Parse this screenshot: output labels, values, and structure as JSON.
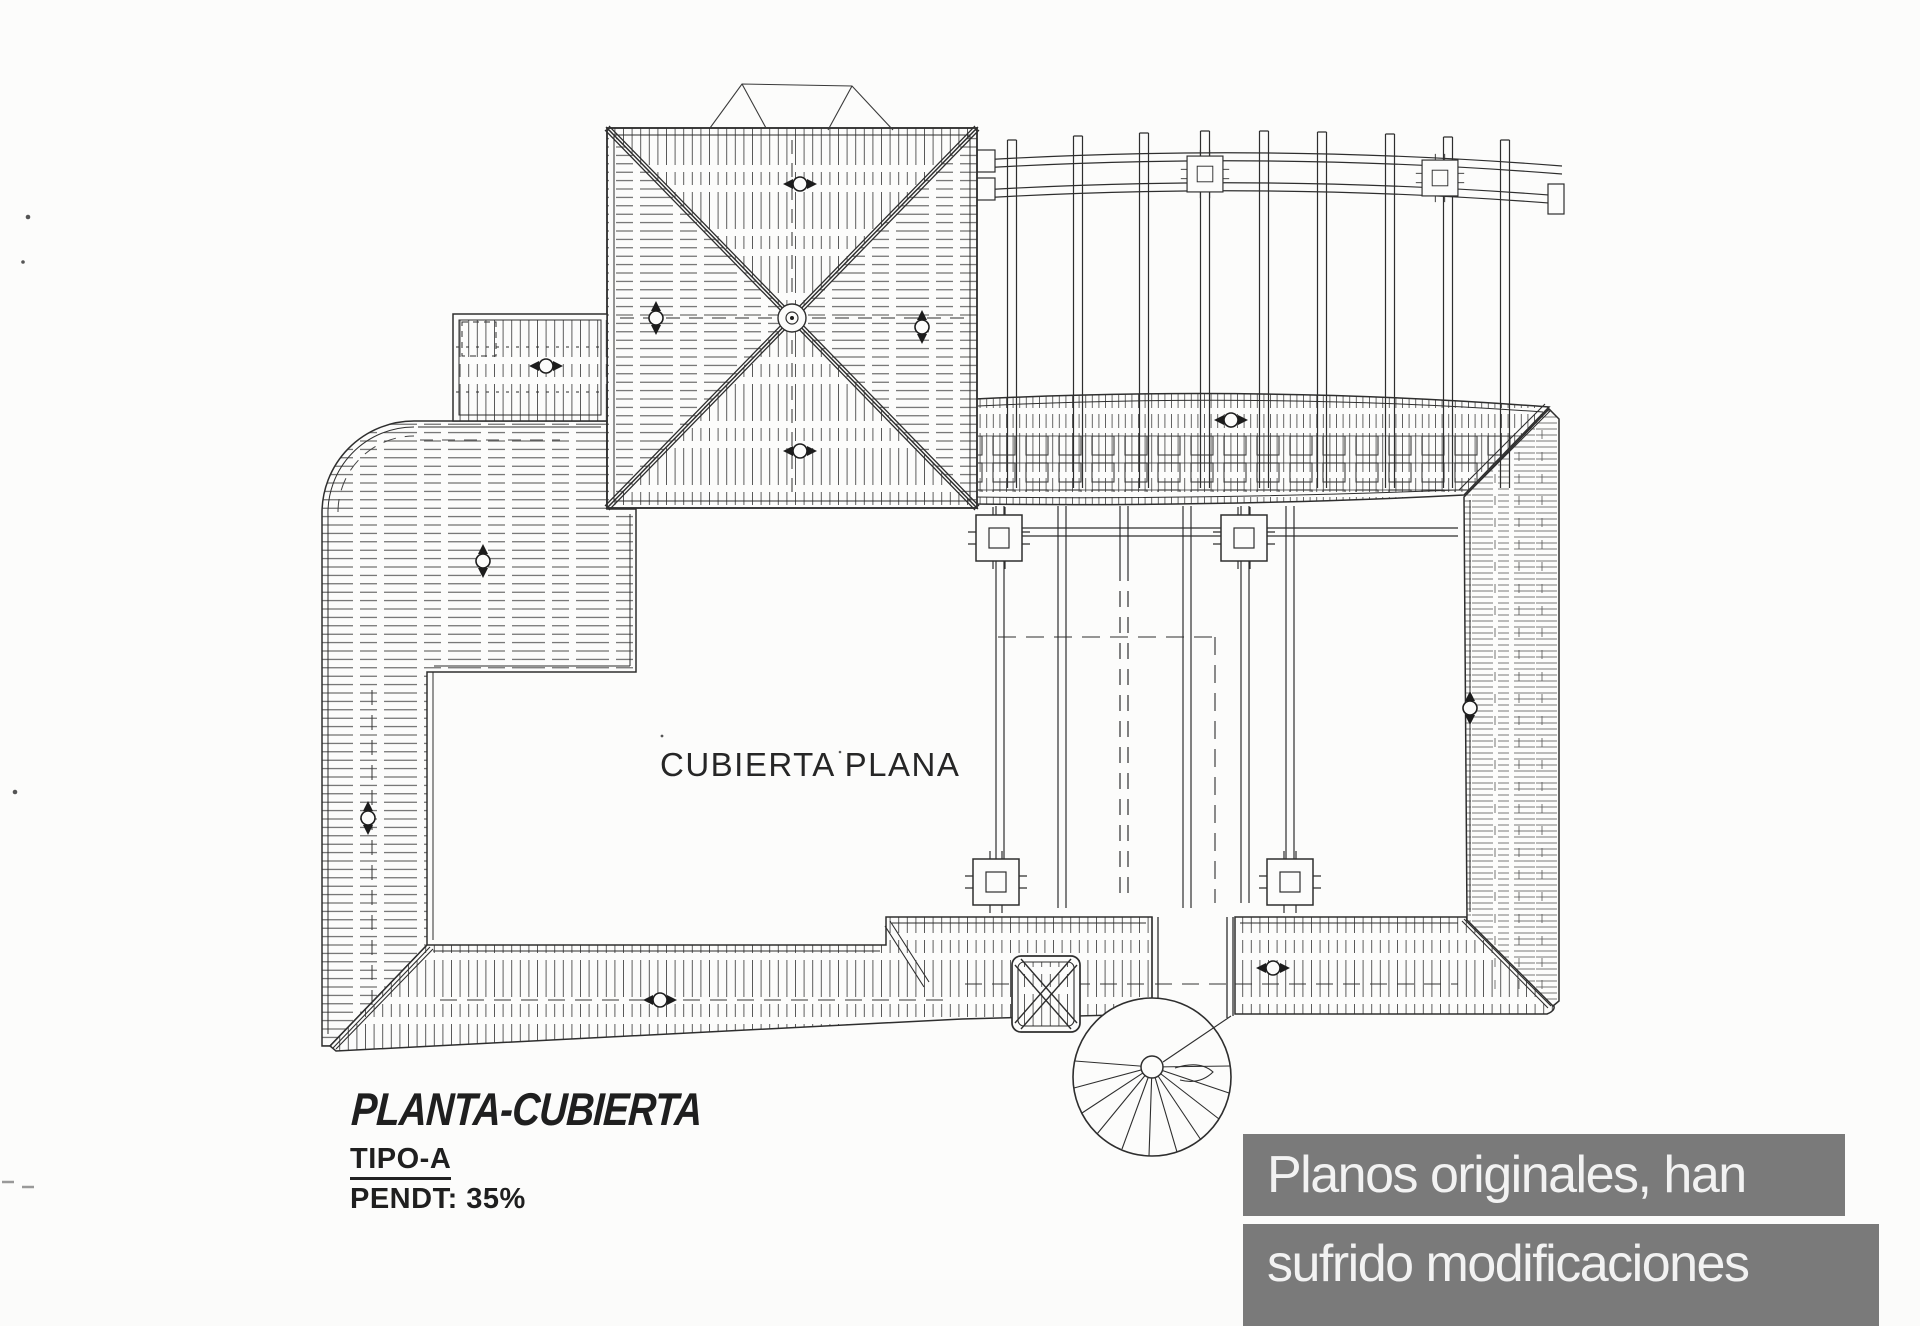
{
  "drawing": {
    "center_label": "CUBIERTA PLANA",
    "title": "PLANTA-CUBIERTA",
    "type_label": "TIPO-A",
    "slope_label": "PENDT: 35%"
  },
  "caption": {
    "line1": "Planos originales, han",
    "line2": "sufrido modificaciones",
    "bg_color": "#7a7a7a",
    "text_color": "#f2f2f2"
  },
  "colors": {
    "paper": "#fcfcfb",
    "ink": "#2e2e2e"
  }
}
